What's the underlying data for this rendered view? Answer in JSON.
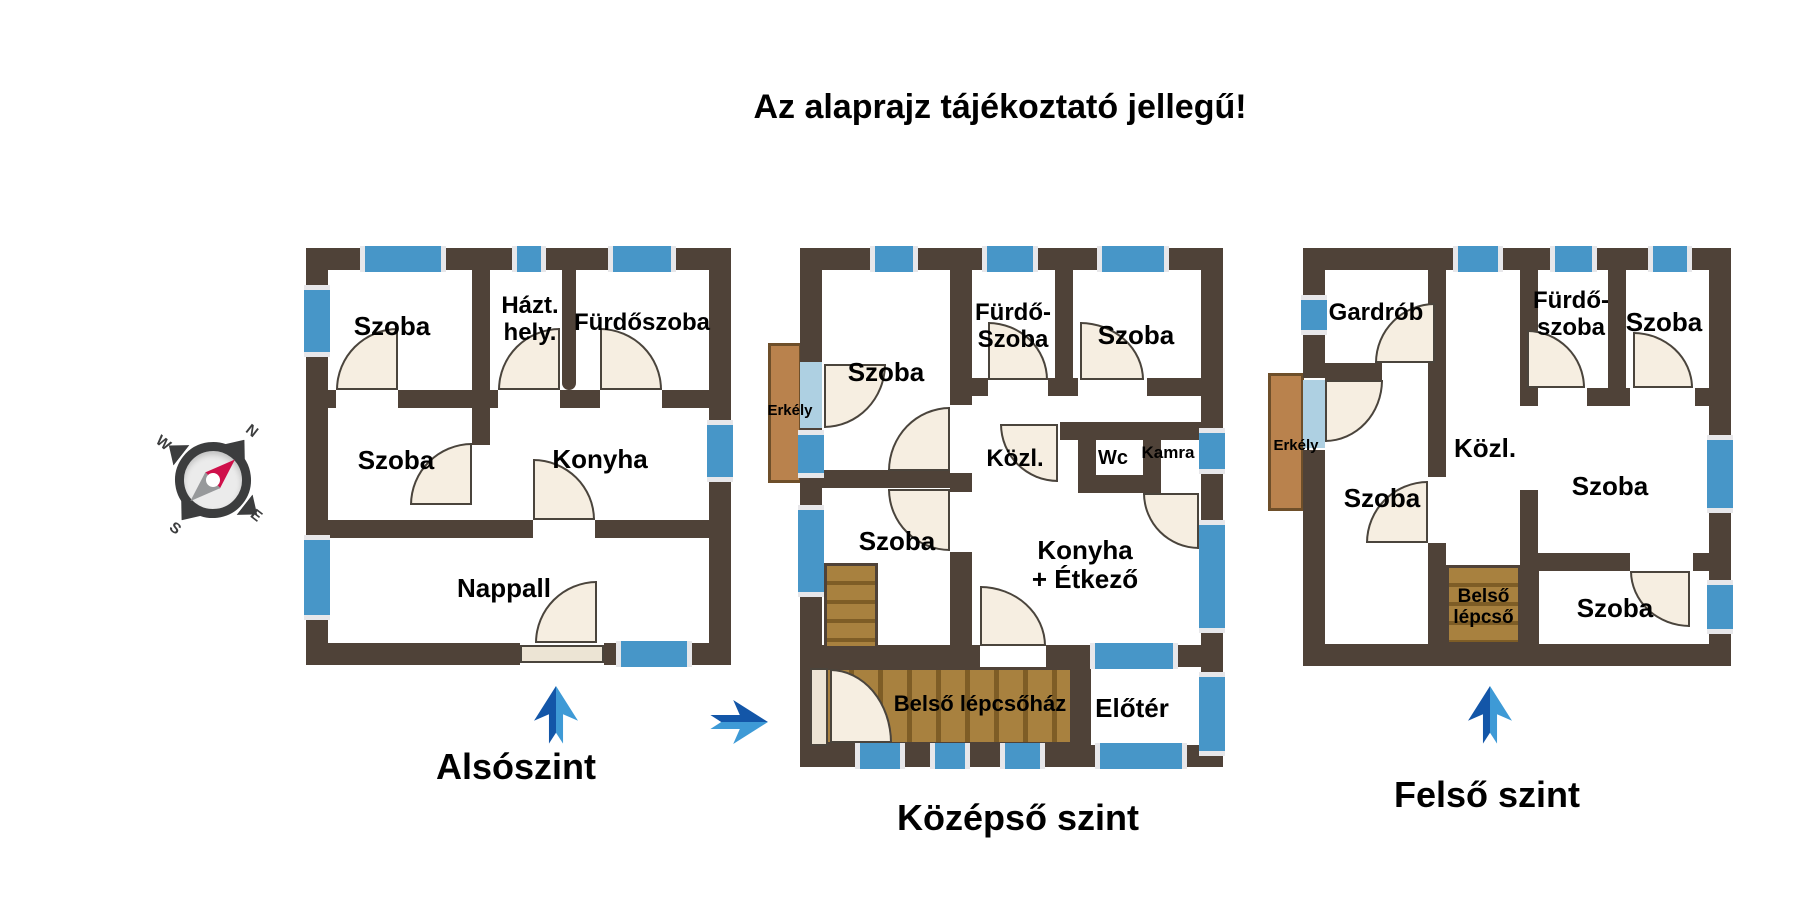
{
  "title": "Az alaprajz tájékoztató jellegű!",
  "colors": {
    "wall": "#4f4238",
    "window": "#4796c8",
    "window_pale": "#aed0e2",
    "wood": "#b9824d",
    "door": "#f6eee1",
    "arrow_dark": "#1356a8",
    "arrow_light": "#3e9ad6",
    "needle_red": "#cf104a"
  },
  "compass": {
    "n": "N",
    "e": "E",
    "s": "S",
    "w": "W"
  },
  "floors": {
    "lower": {
      "label": "Alsószint",
      "rooms": {
        "szoba_top": "Szoba",
        "hazt": "Házt.\nhely.",
        "furdoszoba": "Fürdőszoba",
        "szoba_mid": "Szoba",
        "konyha": "Konyha",
        "nappali": "Nappall"
      }
    },
    "middle": {
      "label": "Középső szint",
      "rooms": {
        "szoba_top": "Szoba",
        "furdo": "Fürdő-\nSzoba",
        "szoba_topright": "Szoba",
        "kozl": "Közl.",
        "wc": "Wc",
        "kamra": "Kamra",
        "erkely": "Erkély",
        "szoba_mid": "Szoba",
        "konyha": "Konyha\n+ Étkező",
        "lepcsohaz": "Belső lépcsőház",
        "eloter": "Előtér"
      }
    },
    "upper": {
      "label": "Felső szint",
      "rooms": {
        "gardrob": "Gardrób",
        "furdo": "Fürdő-\nszoba",
        "szoba_topright": "Szoba",
        "erkely": "Erkély",
        "kozl": "Közl.",
        "szoba_left": "Szoba",
        "szoba_right": "Szoba",
        "belso_lepcso": "Belső\nlépcső",
        "szoba_bottom": "Szoba"
      }
    }
  }
}
